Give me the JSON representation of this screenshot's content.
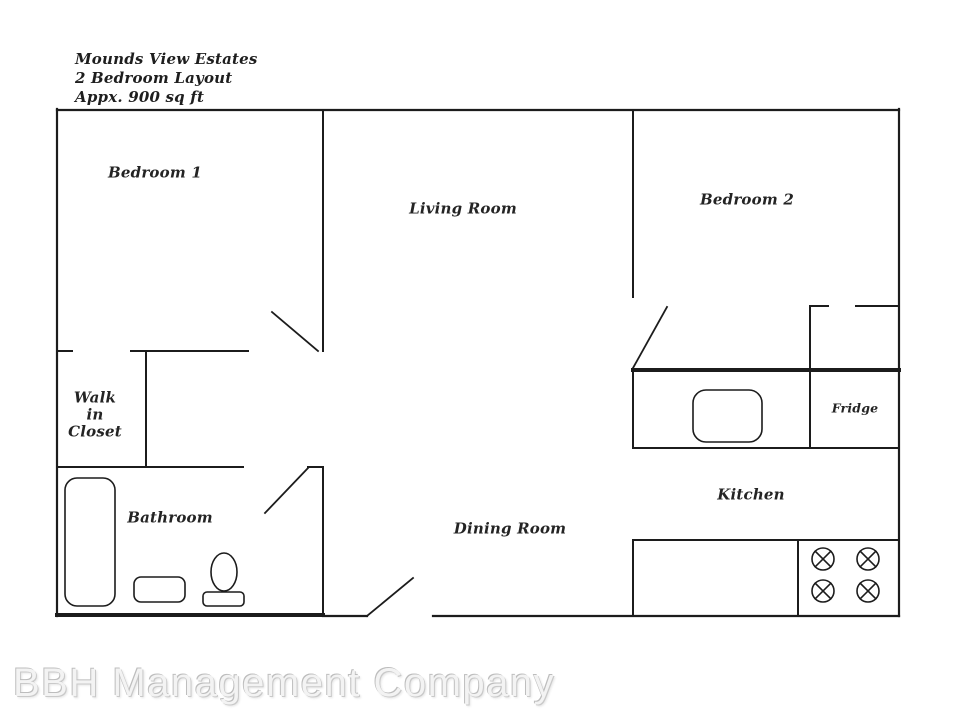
{
  "title": {
    "text": "Mounds View Estates\n2 Bedroom Layout\nAppx. 900 sq ft"
  },
  "rooms": {
    "bedroom1": "Bedroom 1",
    "living_room": "Living Room",
    "bedroom2": "Bedroom 2",
    "walk_in_closet": "Walk\nin\nCloset",
    "bathroom": "Bathroom",
    "dining_room": "Dining Room",
    "kitchen": "Kitchen",
    "fridge": "Fridge"
  },
  "watermark": {
    "text": "BBH Management Company"
  },
  "colors": {
    "wall": "#1c1c1c",
    "label": "#242424",
    "watermark": "#f3f3f3",
    "background": "#ffffff"
  },
  "fixture_icons": [
    "bathtub-icon",
    "bathroom-sink-icon",
    "toilet-icon",
    "kitchen-sink-icon",
    "stove-burner-icon"
  ]
}
